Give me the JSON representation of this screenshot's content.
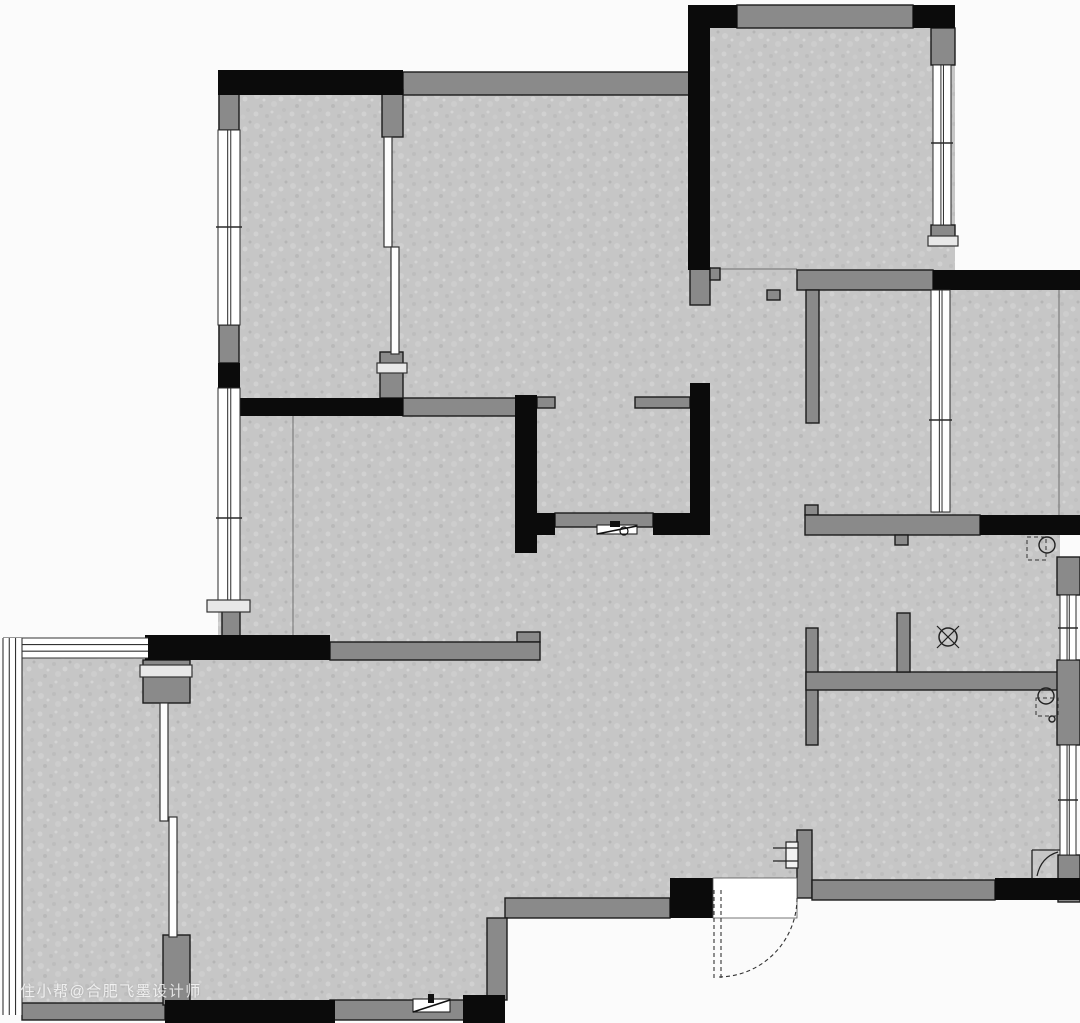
{
  "watermark": {
    "text": "住小帮@合肥飞墨设计师"
  },
  "plan": {
    "colors": {
      "bg": "#fbfbfb",
      "floor": "#c6c6c6",
      "black_wall": "#0b0b0b",
      "gray_wall": "#8a8a8a",
      "wall_stroke": "#1b1b1b",
      "line": "#333333",
      "thin_line": "#6e6e6e",
      "window_frame": "#2a2a2a"
    },
    "floors": [
      [
        218,
        72,
        490,
        344
      ],
      [
        690,
        5,
        265,
        285
      ],
      [
        797,
        270,
        283,
        265
      ],
      [
        690,
        270,
        110,
        150
      ],
      [
        218,
        416,
        842,
        482
      ],
      [
        22,
        638,
        143,
        382
      ],
      [
        165,
        660,
        340,
        360
      ],
      [
        505,
        660,
        205,
        258
      ]
    ],
    "black_walls": [
      [
        218,
        70,
        185,
        25
      ],
      [
        688,
        5,
        22,
        265
      ],
      [
        690,
        5,
        47,
        23
      ],
      [
        913,
        5,
        42,
        23
      ],
      [
        933,
        270,
        147,
        20
      ],
      [
        218,
        363,
        22,
        27
      ],
      [
        220,
        398,
        183,
        18
      ],
      [
        515,
        395,
        22,
        158
      ],
      [
        515,
        513,
        40,
        22
      ],
      [
        690,
        383,
        20,
        134
      ],
      [
        653,
        513,
        57,
        22
      ],
      [
        980,
        515,
        100,
        20
      ],
      [
        145,
        635,
        185,
        25
      ],
      [
        165,
        1000,
        170,
        23
      ],
      [
        463,
        995,
        42,
        28
      ],
      [
        670,
        878,
        43,
        40
      ],
      [
        995,
        878,
        85,
        22
      ]
    ],
    "gray_walls": [
      [
        403,
        72,
        287,
        23
      ],
      [
        737,
        5,
        176,
        23
      ],
      [
        219,
        85,
        20,
        45
      ],
      [
        219,
        325,
        20,
        38
      ],
      [
        222,
        600,
        18,
        42
      ],
      [
        382,
        90,
        21,
        47
      ],
      [
        380,
        352,
        23,
        46
      ],
      [
        403,
        398,
        114,
        18
      ],
      [
        537,
        397,
        18,
        11
      ],
      [
        635,
        397,
        55,
        11
      ],
      [
        555,
        513,
        98,
        14
      ],
      [
        690,
        268,
        20,
        37
      ],
      [
        710,
        268,
        10,
        12
      ],
      [
        797,
        270,
        136,
        20
      ],
      [
        806,
        290,
        13,
        133
      ],
      [
        767,
        290,
        13,
        10
      ],
      [
        805,
        505,
        13,
        10
      ],
      [
        805,
        515,
        175,
        20
      ],
      [
        895,
        535,
        13,
        10
      ],
      [
        806,
        628,
        12,
        117
      ],
      [
        806,
        672,
        254,
        18
      ],
      [
        897,
        613,
        13,
        59
      ],
      [
        797,
        830,
        15,
        68
      ],
      [
        812,
        880,
        183,
        20
      ],
      [
        505,
        898,
        165,
        20
      ],
      [
        487,
        918,
        20,
        82
      ],
      [
        330,
        1000,
        135,
        20
      ],
      [
        22,
        1003,
        143,
        17
      ],
      [
        143,
        660,
        47,
        43
      ],
      [
        163,
        935,
        27,
        70
      ],
      [
        931,
        28,
        24,
        37
      ],
      [
        931,
        225,
        24,
        20
      ],
      [
        1057,
        557,
        23,
        38
      ],
      [
        1057,
        660,
        23,
        85
      ],
      [
        1058,
        855,
        22,
        47
      ],
      [
        517,
        632,
        23,
        10
      ],
      [
        330,
        642,
        210,
        18
      ]
    ],
    "windows": [
      {
        "r": [
          218,
          130,
          22,
          195
        ],
        "tick": 227
      },
      {
        "r": [
          218,
          388,
          22,
          212
        ],
        "tick": 518
      },
      {
        "r": [
          933,
          65,
          18,
          160
        ],
        "tick": 143
      },
      {
        "r": [
          931,
          290,
          19,
          222
        ],
        "tick": 420
      },
      {
        "r": [
          1060,
          595,
          16,
          65
        ],
        "tick": 628
      },
      {
        "r": [
          1060,
          745,
          16,
          110
        ],
        "tick": 800
      }
    ],
    "glazing_strips": [
      {
        "r": [
          3,
          638,
          145,
          20
        ],
        "orient": "h"
      },
      {
        "r": [
          3,
          638,
          19,
          377
        ],
        "orient": "v"
      }
    ],
    "sliding_panels": [
      [
        384,
        137,
        8,
        110
      ],
      [
        391,
        247,
        8,
        107
      ],
      [
        160,
        703,
        8,
        118
      ],
      [
        169,
        817,
        8,
        120
      ]
    ],
    "handle_bars": [
      [
        377,
        363,
        30,
        10
      ],
      [
        140,
        665,
        52,
        12
      ],
      [
        928,
        236,
        30,
        10
      ],
      [
        207,
        600,
        43,
        12
      ]
    ],
    "thin_lines": [
      [
        293,
        416,
        293,
        642
      ],
      [
        1059,
        290,
        1059,
        515
      ],
      [
        720,
        269,
        797,
        269
      ],
      [
        713,
        898,
        797,
        898
      ]
    ],
    "door": {
      "opening": [
        713,
        878,
        84,
        40
      ],
      "leaf_x": [
        714,
        721
      ],
      "leaf_y": [
        890,
        978
      ],
      "arc": {
        "cx": 718,
        "cy": 898,
        "r": 79
      }
    },
    "fixtures": {
      "drain": {
        "cx": 948,
        "cy": 637,
        "r": 9
      },
      "circles": [
        {
          "cx": 1047,
          "cy": 545,
          "r": 8
        },
        {
          "cx": 1046,
          "cy": 696,
          "r": 8
        },
        {
          "cx": 1052,
          "cy": 719,
          "r": 3
        }
      ],
      "dashed_boxes": [
        [
          1027,
          537,
          19,
          23
        ],
        [
          1036,
          698,
          22,
          18
        ]
      ],
      "corner_mark": {
        "lines": [
          [
            1032,
            878,
            1032,
            850
          ],
          [
            1032,
            850,
            1060,
            850
          ]
        ],
        "curve": "M1037,876 Q1041,857 1058,852"
      },
      "door_stop": {
        "rect": [
          786,
          842,
          12,
          26
        ],
        "ticks": [
          [
            773,
            848,
            798,
            848
          ],
          [
            773,
            861,
            798,
            861
          ]
        ]
      },
      "vents": [
        {
          "rect": [
            597,
            525,
            40,
            9
          ],
          "diag": [
            597,
            534,
            637,
            526
          ],
          "dot": {
            "cx": 624,
            "cy": 531,
            "r": 4
          },
          "tick": [
            610,
            521,
            10,
            6
          ]
        },
        {
          "rect": [
            413,
            999,
            37,
            13
          ],
          "diag": [
            413,
            1012,
            450,
            1000
          ],
          "dot": null,
          "tick": [
            428,
            994,
            6,
            9
          ]
        }
      ]
    }
  }
}
